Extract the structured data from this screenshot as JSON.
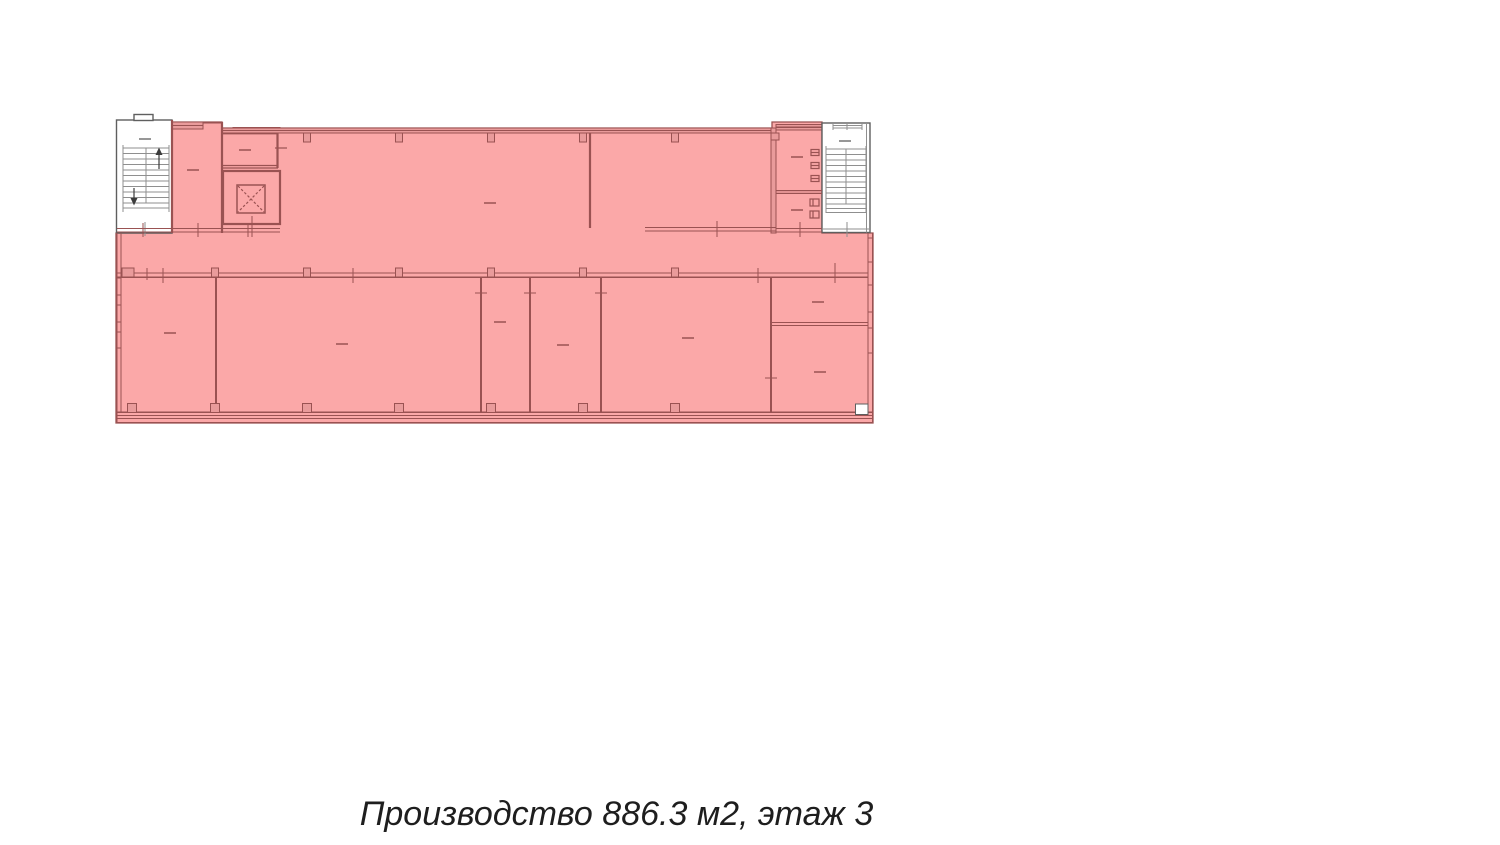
{
  "page": {
    "background": "#ffffff"
  },
  "caption": {
    "text": "Производство 886.3 м2, этаж 3"
  },
  "floor_plan": {
    "kind": "architectural floor plan with highlighted production area",
    "highlighted": true,
    "colors": {
      "highlight_fill": "#fba8a8",
      "wall_band_fill": "#e99b9b",
      "wall_line": "#9a5252",
      "stair_line": "#8f8f8f",
      "white_block_line": "#5f5f5f",
      "arrow_color": "#3c3c3c",
      "white_fill": "#ffffff"
    }
  }
}
